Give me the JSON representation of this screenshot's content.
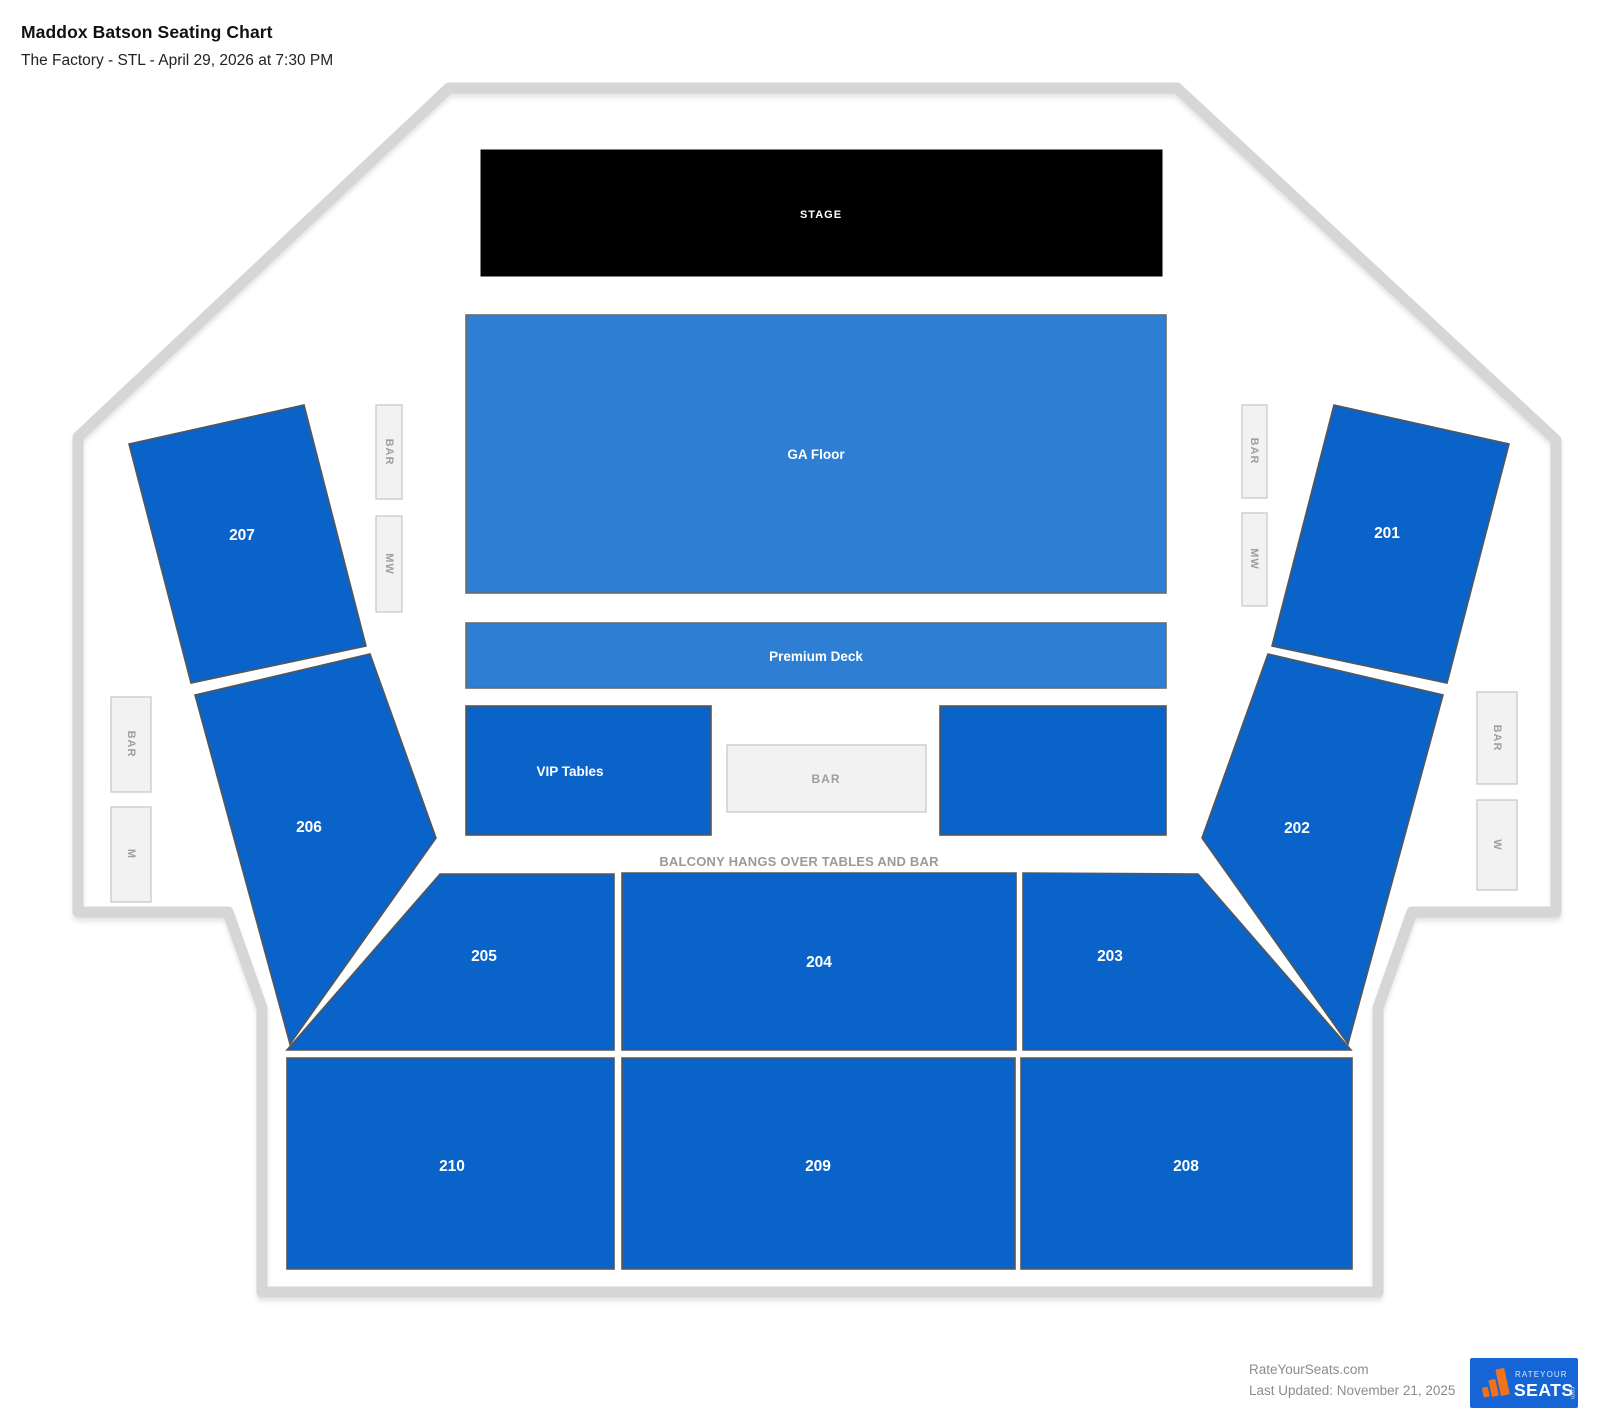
{
  "header": {
    "title": "Maddox Batson Seating Chart",
    "subtitle": "The Factory - STL - April 29, 2026 at 7:30 PM"
  },
  "stage": {
    "label": "STAGE"
  },
  "floor": {
    "ga_label": "GA Floor",
    "premium_label": "Premium Deck",
    "vip_label": "VIP Tables",
    "center_bar_label": "BAR"
  },
  "notes": {
    "balcony": "BALCONY HANGS OVER TABLES AND BAR"
  },
  "amenities": {
    "left_inner_bar": "BAR",
    "left_inner_mw": "MW",
    "left_outer_bar": "BAR",
    "left_outer_m": "M",
    "right_inner_bar": "BAR",
    "right_inner_mw": "MW",
    "right_outer_bar": "BAR",
    "right_outer_w": "W"
  },
  "sections": {
    "s201": "201",
    "s202": "202",
    "s203": "203",
    "s204": "204",
    "s205": "205",
    "s206": "206",
    "s207": "207",
    "s208": "208",
    "s209": "209",
    "s210": "210"
  },
  "footer": {
    "site": "RateYourSeats.com",
    "updated": "Last Updated: November 21, 2025",
    "logo_top": "RATEYOUR",
    "logo_main": "SEATS",
    "logo_dot": ".com"
  },
  "colors": {
    "section_blue": "#0a63c9",
    "floor_blue": "#2e7ed4",
    "stage_black": "#000000",
    "outline_gray": "#d6d6d6",
    "amenity_fill": "#f2f2f2",
    "amenity_border": "#c9c9c9",
    "amenity_text": "#9e9e9e",
    "note_text": "#9a9a9a",
    "footer_text": "#8c8c8c",
    "logo_blue": "#1565d6",
    "logo_orange": "#f2711c",
    "label_white": "#ffffff"
  }
}
